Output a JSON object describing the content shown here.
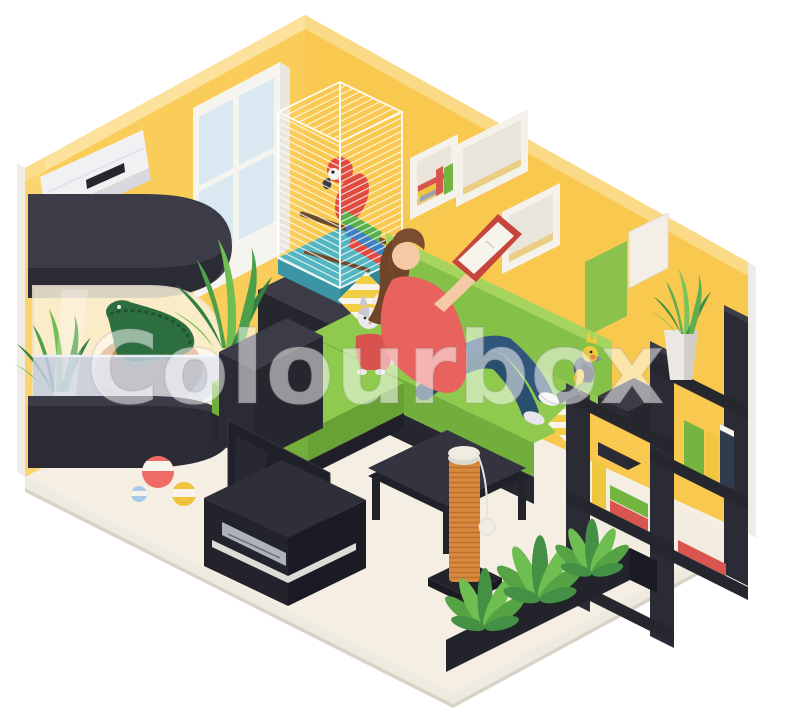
{
  "meta": {
    "watermark": "Colourbox",
    "description": "Isometric living room with pets: woman reading on a green corner sofa with a cat in a sweater, macaw in a cage, cockatiel on a shelf, crocodile terrarium, plants and pet toys",
    "canvas": {
      "width": 800,
      "height": 720
    }
  },
  "colors": {
    "wall": "#FACD5A",
    "wallBevel": "#FCE29C",
    "wallRight": "#F9C84E",
    "wallRightBevel": "#FBDA87",
    "wallEdge": "#EFECE5",
    "wallLightStrip": "#FBD97F",
    "floor": "#F5EEE2",
    "floorBand": "#EFEAE1",
    "floorBandDark": "#D8D2C7",
    "dark": "#2B2B35",
    "darker": "#20202A",
    "darkTop": "#3C3C48",
    "darkMid": "#26262F",
    "glassTint": "#FBF2DC",
    "glassLine": "#EFE6D2",
    "water": "#C3CCDF",
    "waterLine": "#E8EDF4",
    "rock": "#C68A4F",
    "rockDark": "#A96F3B",
    "croc": "#2D6E3E",
    "crocDark": "#1F5530",
    "crocBelly": "#9CC56F",
    "weed1": "#4DA04A",
    "weed2": "#357F41",
    "weed3": "#6FBE52",
    "acBody": "#F1F1F4",
    "acShade": "#D8D8DF",
    "acVent": "#26262E",
    "winFrame": "#F6F4EF",
    "winPane": "#DAE8F1",
    "winJamb": "#E9E6DF",
    "cubeFace": "#F5F2EB",
    "cubeInner": "#EAE5DA",
    "cubeSliver": "#E9BE4E",
    "bookRed": "#D85550",
    "bookYellow": "#EFC73F",
    "bookGreen": "#74B53F",
    "bookNavy": "#2E3A4E",
    "bookGrey": "#9AA0B0",
    "pagesWhite": "#F7F4EC",
    "frameGreen": "#8DC14E",
    "frameWhite": "#F3EFE7",
    "trayTeal": "#52B5BF",
    "trayTealDark": "#3B95A3",
    "trayTealSide": "#2F8795",
    "wire": "#FFFFFF",
    "perch": "#6E4A2C",
    "parrotRed": "#E14B3F",
    "parrotWingGreen": "#57B04A",
    "parrotWingBlue": "#3E7FC2",
    "parrotFace": "#F3EFE8",
    "beak": "#3A3A40",
    "sofaGreen": "#8FCA4F",
    "sofaGreenFront": "#72AE3B",
    "sofaBack": "#85C148",
    "sofaBevel": "#A5D45F",
    "sofaGreenSide": "#68A235",
    "pillowBase": "#F8F4EC",
    "pillowStripe": "#F2CE45",
    "skin": "#F5C9A3",
    "hair": "#7B4C2F",
    "hairDark": "#6F4429",
    "shirt": "#E8635E",
    "jeans": "#30567B",
    "jeansDark": "#2A4E6E",
    "shoe": "#F2F2F4",
    "shoeShade": "#E6E6EA",
    "bookCover": "#C6463E",
    "catWhite": "#ECEAEE",
    "catGrey": "#C9C6CE",
    "catSweater": "#D9534E",
    "catTail": "#CFCCD2",
    "birdSlate": "#525C74",
    "birdSlateDark": "#3A4152",
    "birdYellow": "#F0C93F",
    "birdCheek": "#E8883F",
    "tv": "#20202A",
    "tvStand": "#2F2F3A",
    "tvStandL": "#23232C",
    "tvStandR": "#1B1B24",
    "tvStrip": "#E8E6E2",
    "dvd": "#AEB2BD",
    "post": "#D8893C",
    "rope": "#BA7030",
    "postCap": "#EFECE4",
    "toyBall": "#F0EDE6",
    "ballRed": "#EE6B66",
    "ballBand": "#F8F4EC",
    "ballBlue": "#A9CAE8",
    "beachYellow": "#F0C33F",
    "potWhite": "#ECE9E4",
    "potShade": "#D2CFC9",
    "leaf1": "#55A344",
    "leaf2": "#6FBE52",
    "leaf3": "#449044",
    "s1": "#3E8F43",
    "s2": "#5FAE4F",
    "s3": "#79C45F"
  },
  "scene": {
    "items": [
      {
        "name": "air-conditioner",
        "label": "Air conditioner"
      },
      {
        "name": "window",
        "label": "Window"
      },
      {
        "name": "terrarium",
        "label": "Terrarium with crocodile"
      },
      {
        "name": "bird-cage",
        "label": "Cage with macaw parrot"
      },
      {
        "name": "cube-shelves",
        "label": "White wall cube shelves with books"
      },
      {
        "name": "picture-frames",
        "label": "Picture frames"
      },
      {
        "name": "corner-sofa",
        "label": "Green corner sofa"
      },
      {
        "name": "woman-reading",
        "label": "Woman reading a book"
      },
      {
        "name": "cat",
        "label": "Cat in a red sweater"
      },
      {
        "name": "cockatiel",
        "label": "Cockatiel on shelf"
      },
      {
        "name": "shelf-unit",
        "label": "Dark shelf unit with books and plant"
      },
      {
        "name": "tv",
        "label": "TV with media stand"
      },
      {
        "name": "coffee-table",
        "label": "Coffee table"
      },
      {
        "name": "scratching-post",
        "label": "Cat scratching post"
      },
      {
        "name": "toy-balls",
        "label": "Toy balls"
      },
      {
        "name": "floor-planter",
        "label": "Floor planter with plants"
      }
    ]
  }
}
